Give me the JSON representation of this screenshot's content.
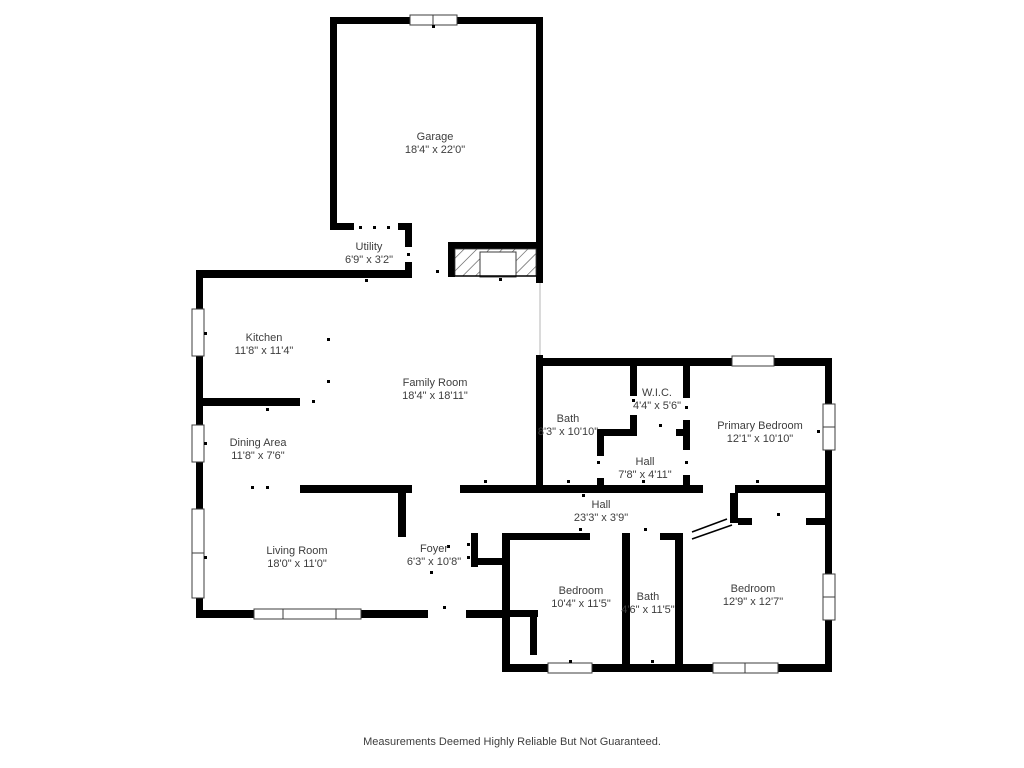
{
  "floor_plan": {
    "wall_color": "#000000",
    "label_color": "#3d3d3d",
    "background_color": "#ffffff",
    "disclaimer": "Measurements Deemed Highly Reliable But Not Guaranteed.",
    "rooms": [
      {
        "id": "garage",
        "name": "Garage",
        "dims": "18'4\" x 22'0\"",
        "x": 435,
        "y": 140
      },
      {
        "id": "utility",
        "name": "Utility",
        "dims": "6'9\" x 3'2\"",
        "x": 369,
        "y": 250
      },
      {
        "id": "kitchen",
        "name": "Kitchen",
        "dims": "11'8\" x 11'4\"",
        "x": 264,
        "y": 341
      },
      {
        "id": "family-room",
        "name": "Family Room",
        "dims": "18'4\" x 18'11\"",
        "x": 435,
        "y": 386
      },
      {
        "id": "dining-area",
        "name": "Dining Area",
        "dims": "11'8\" x 7'6\"",
        "x": 258,
        "y": 446
      },
      {
        "id": "living-room",
        "name": "Living Room",
        "dims": "18'0\" x 11'0\"",
        "x": 297,
        "y": 554
      },
      {
        "id": "foyer",
        "name": "Foyer",
        "dims": "6'3\" x 10'8\"",
        "x": 434,
        "y": 552
      },
      {
        "id": "bath-main",
        "name": "Bath",
        "dims": "8'3\" x 10'10\"",
        "x": 568,
        "y": 422
      },
      {
        "id": "wic",
        "name": "W.I.C.",
        "dims": "4'4\" x 5'6\"",
        "x": 657,
        "y": 396
      },
      {
        "id": "primary-bedroom",
        "name": "Primary Bedroom",
        "dims": "12'1\" x 10'10\"",
        "x": 760,
        "y": 429
      },
      {
        "id": "hall-inner",
        "name": "Hall",
        "dims": "7'8\" x 4'11\"",
        "x": 645,
        "y": 465
      },
      {
        "id": "hall-main",
        "name": "Hall",
        "dims": "23'3\" x 3'9\"",
        "x": 601,
        "y": 508
      },
      {
        "id": "bedroom-left",
        "name": "Bedroom",
        "dims": "10'4\" x 11'5\"",
        "x": 581,
        "y": 594
      },
      {
        "id": "bath-hall",
        "name": "Bath",
        "dims": "4'6\" x 11'5\"",
        "x": 648,
        "y": 600
      },
      {
        "id": "bedroom-right",
        "name": "Bedroom",
        "dims": "12'9\" x 12'7\"",
        "x": 753,
        "y": 592
      }
    ]
  }
}
